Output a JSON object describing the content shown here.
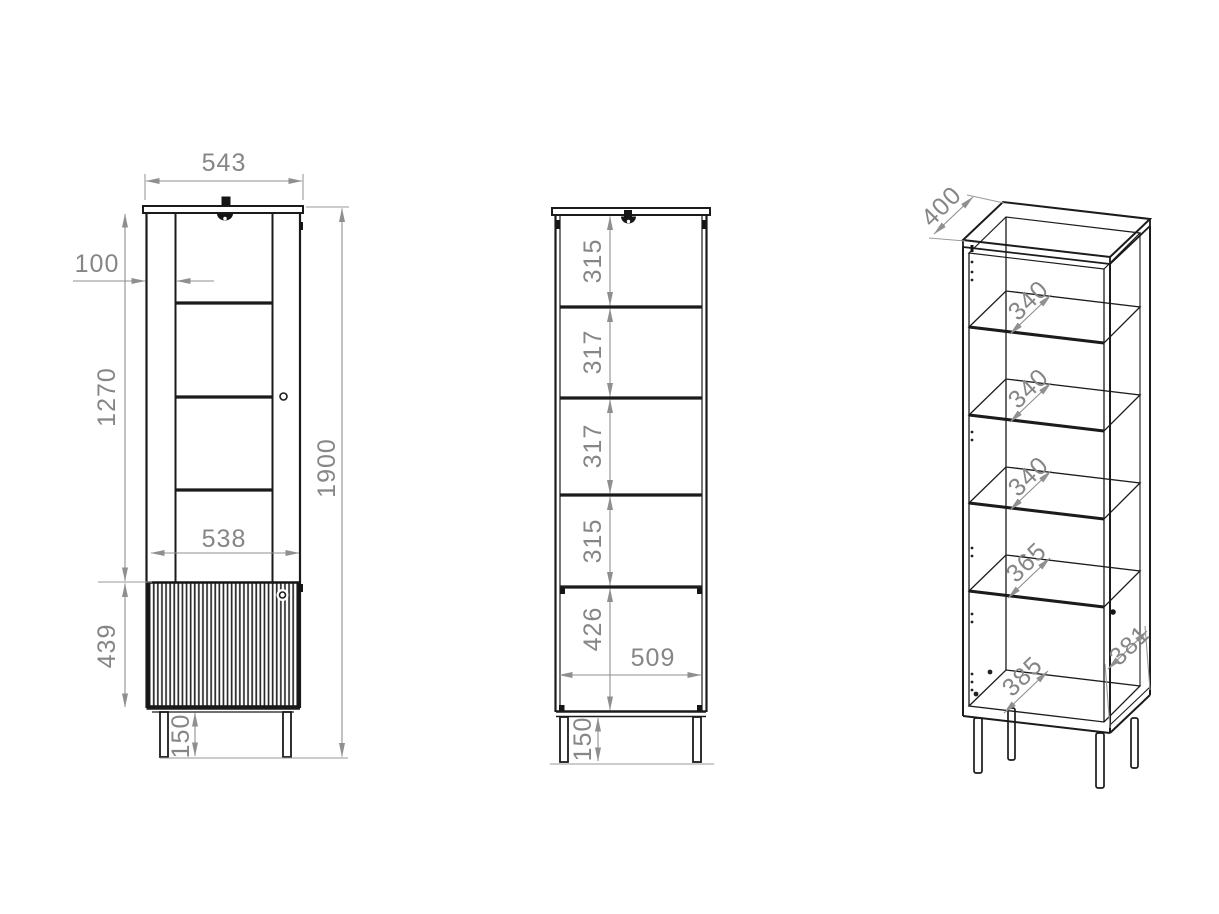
{
  "drawing": {
    "type": "furniture-technical-drawing",
    "subject": "tall display cabinet (vitrine) with glass door, fluted lower door and metal legs",
    "units": "mm",
    "line_color": "#1b1b1b",
    "dim_color": "#868686"
  },
  "views": {
    "front": {
      "label": "front-view-closed",
      "dims": {
        "overall_width": "543",
        "door_stile_width": "100",
        "glass_door_height": "1270",
        "lower_door_height": "439",
        "door_width": "538",
        "overall_height": "1900",
        "leg_height": "150"
      }
    },
    "open": {
      "label": "front-view-internal",
      "dims": {
        "compartment_1": "315",
        "compartment_2": "317",
        "compartment_3": "317",
        "compartment_4": "315",
        "compartment_5": "426",
        "inner_width": "509",
        "leg_height": "150"
      }
    },
    "iso": {
      "label": "perspective-view",
      "dims": {
        "top_depth": "400",
        "shelf_1_depth": "340",
        "shelf_2_depth": "340",
        "shelf_3_depth": "340",
        "shelf_4_depth": "365",
        "bottom_depth": "385",
        "side_depth": "381"
      }
    }
  }
}
